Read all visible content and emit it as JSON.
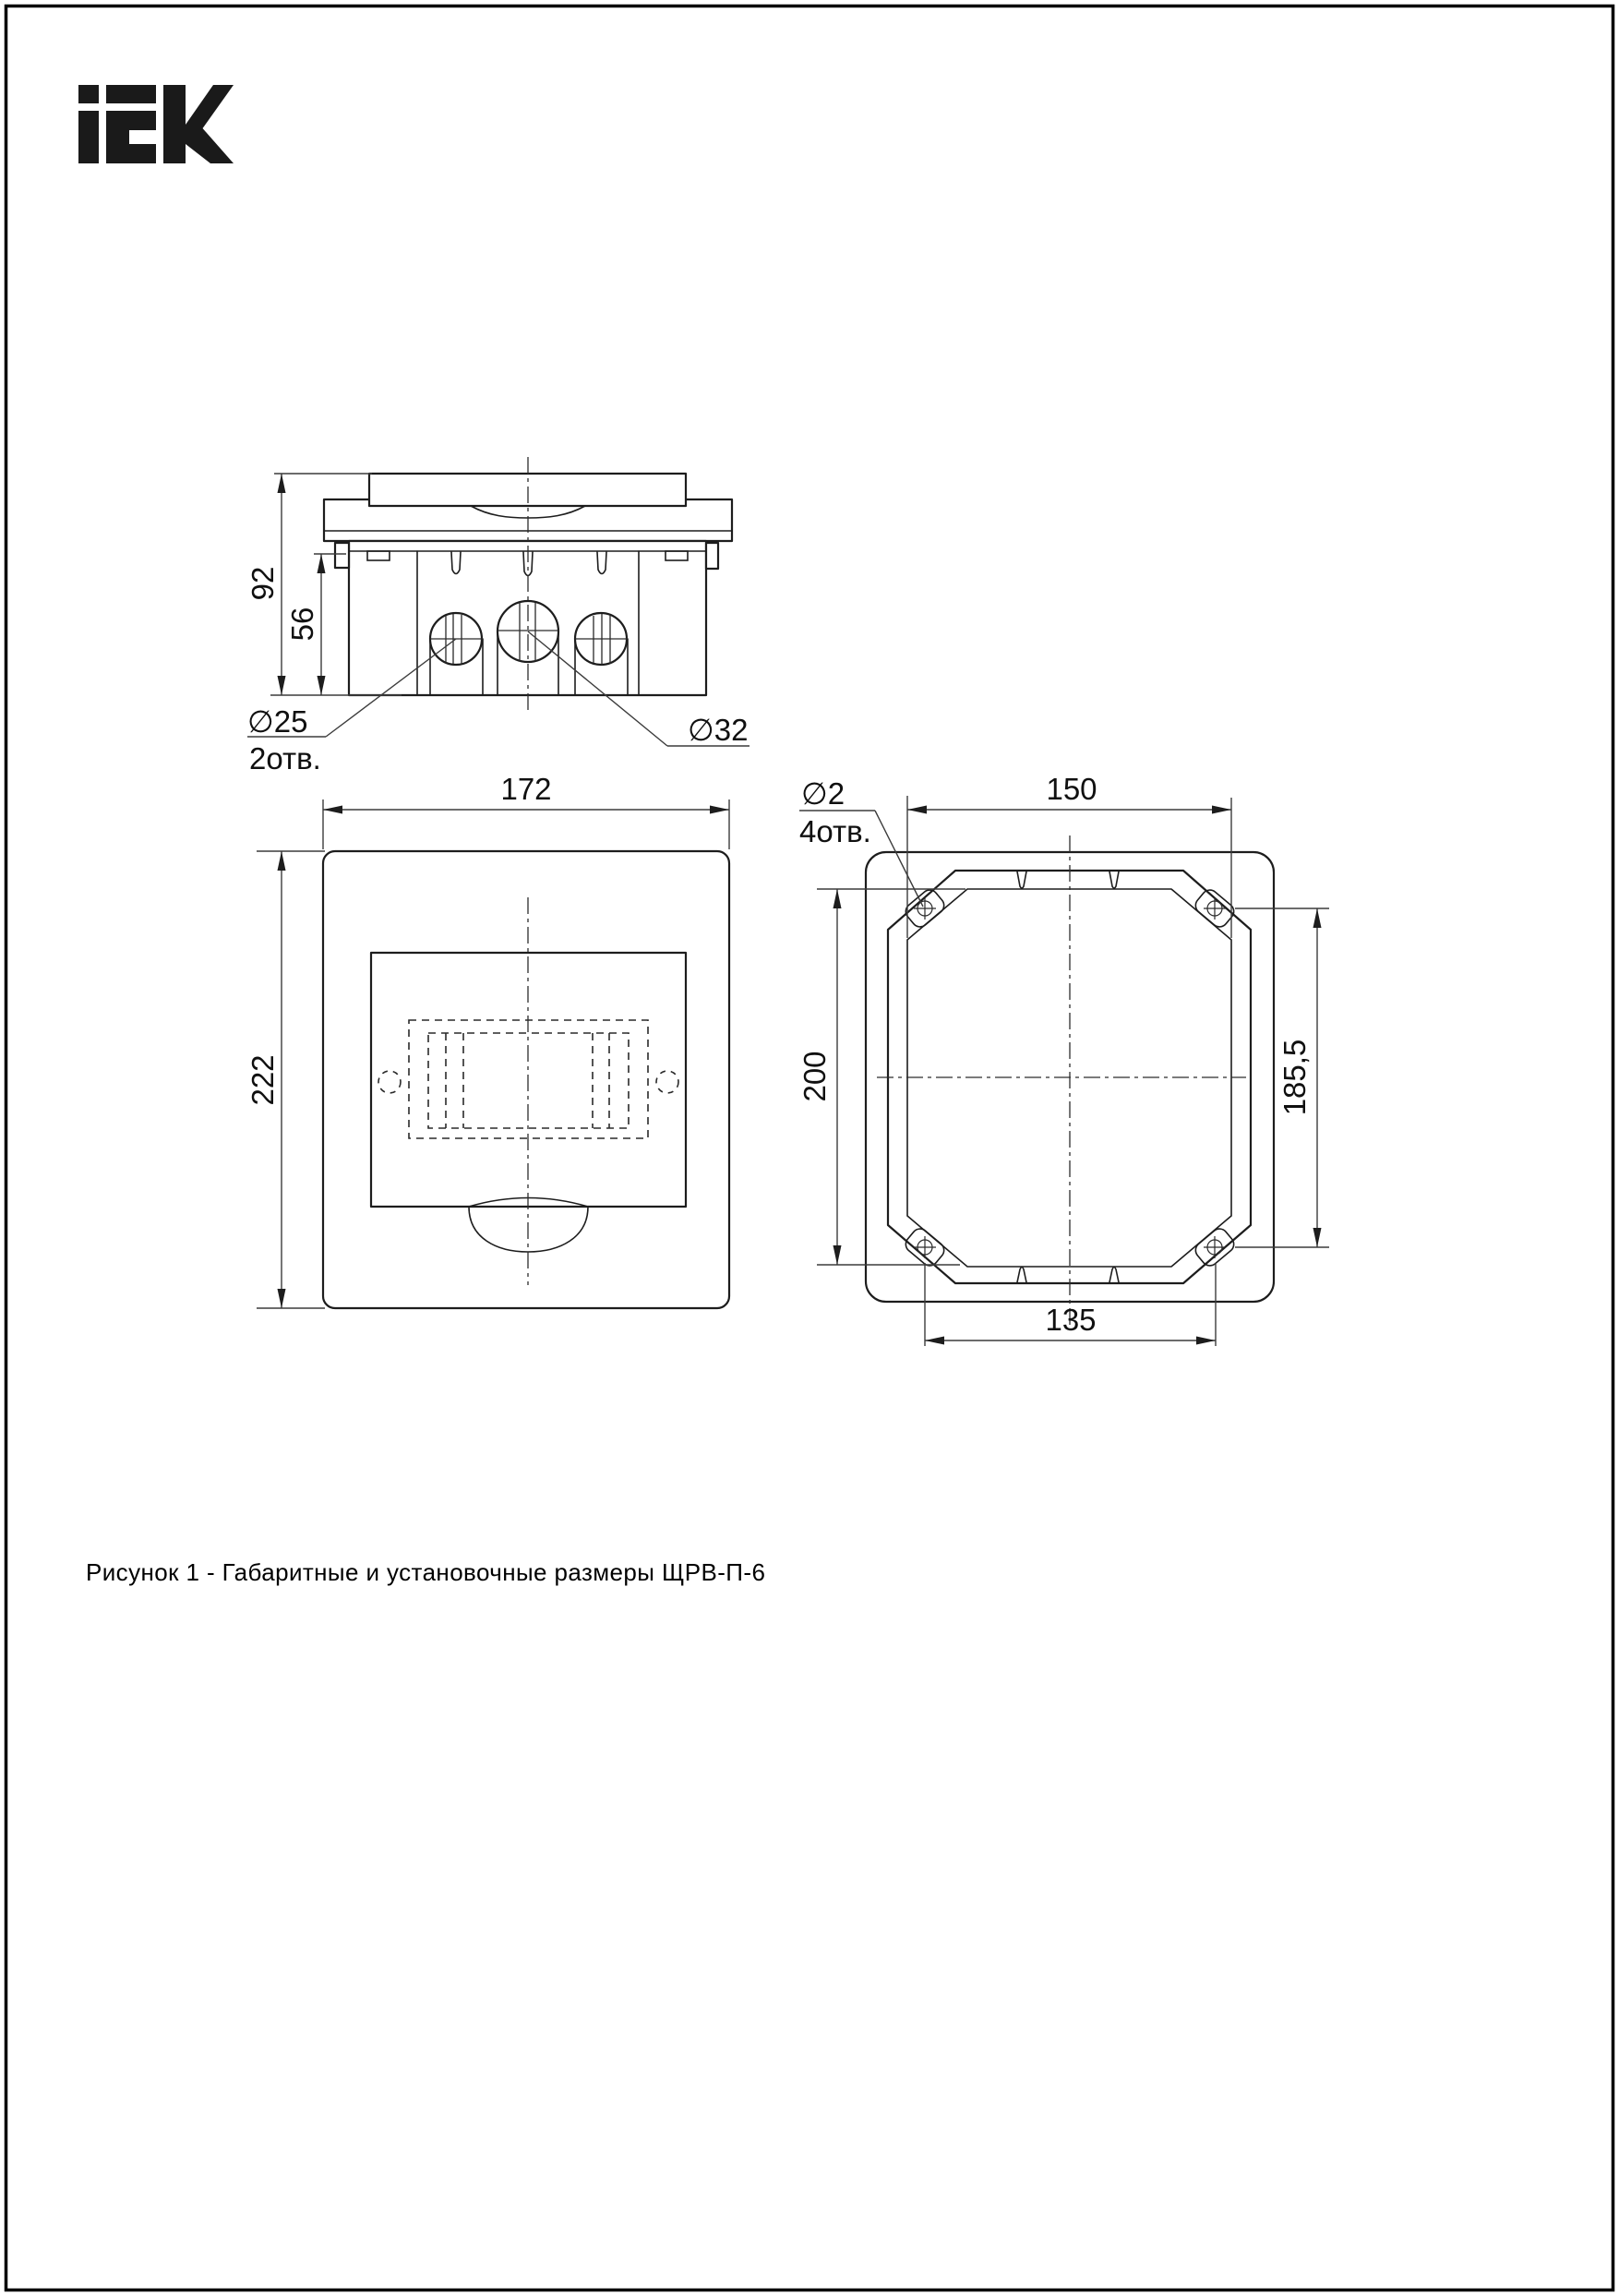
{
  "brand": {
    "logo_label": "IEK"
  },
  "caption": "Рисунок 1 - Габаритные и установочные размеры ЩРВ-П-6",
  "side_view": {
    "dim_height": "92",
    "dim_inner_height": "56",
    "label_d25": "∅25",
    "label_d25_qty": "2отв.",
    "label_d32": "∅32"
  },
  "front_view": {
    "dim_width": "172",
    "dim_height": "222"
  },
  "rear_view": {
    "label_d2": "∅2",
    "label_d2_qty": "4отв.",
    "dim_top": "150",
    "dim_left": "200",
    "dim_right": "185,5",
    "dim_bottom": "135"
  }
}
